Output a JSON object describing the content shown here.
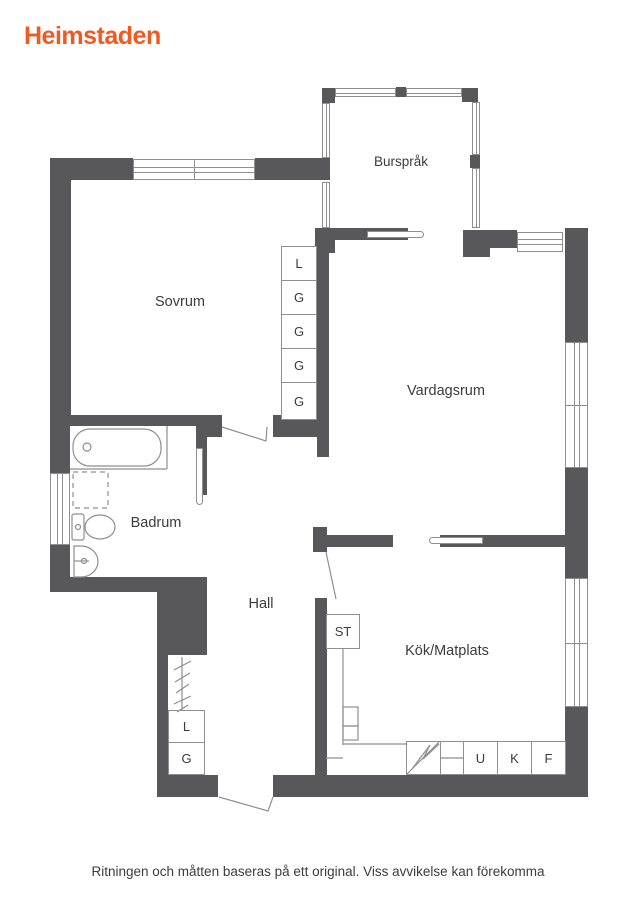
{
  "brand": {
    "logo_text": "Heimstaden"
  },
  "rooms": {
    "bursprak": "Burspråk",
    "sovrum": "Sovrum",
    "vardagsrum": "Vardagsrum",
    "badrum": "Badrum",
    "hall": "Hall",
    "kok_matplats": "Kök/Matplats"
  },
  "closets": {
    "sovrum_column": [
      "L",
      "G",
      "G",
      "G",
      "G"
    ],
    "hall_column": [
      "L",
      "G"
    ],
    "kitchen": {
      "st": "ST"
    },
    "appliances": [
      "U",
      "K",
      "F"
    ]
  },
  "footer": {
    "disclaimer": "Ritningen och måtten baseras på ett original. Viss avvikelse kan förekomma"
  },
  "colors": {
    "wall": "#58585a",
    "fixture_line": "#8f8f8f",
    "logo_orange": "#f05a22",
    "label_text": "#3c3c3c"
  }
}
